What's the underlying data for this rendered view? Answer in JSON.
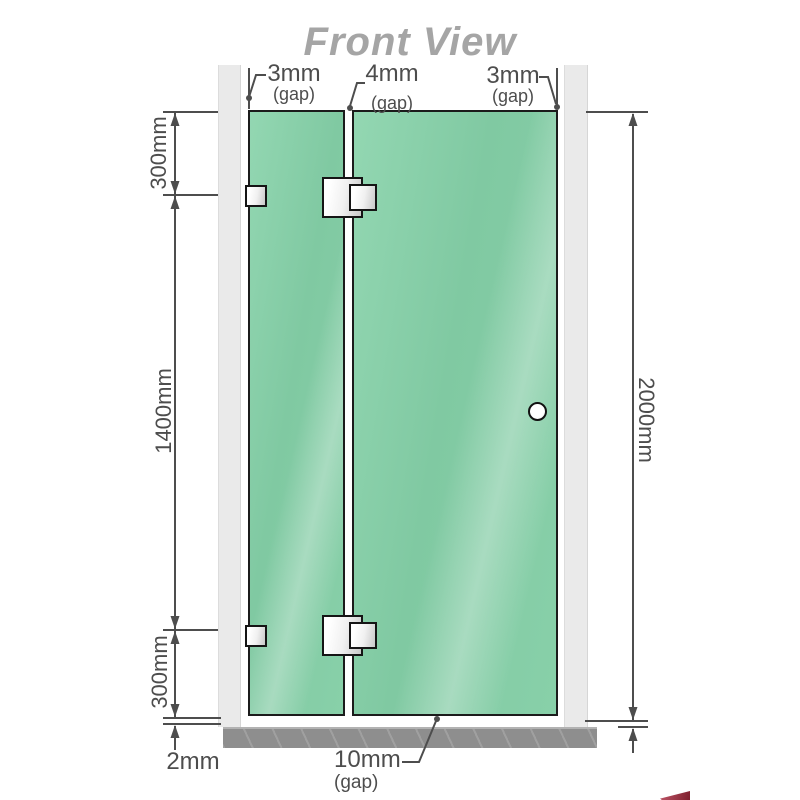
{
  "title": "Front View",
  "annotations": {
    "gap_top_left": {
      "value": "3mm",
      "note": "(gap)"
    },
    "gap_top_center": {
      "value": "4mm",
      "note": "(gap)"
    },
    "gap_top_right": {
      "value": "3mm",
      "note": "(gap)"
    },
    "left_top": "300mm",
    "left_middle": "1400mm",
    "left_bottom": "300mm",
    "right_height": "2000mm",
    "bottom_left": "2mm",
    "gap_bottom": {
      "value": "10mm",
      "note": "(gap)"
    }
  },
  "colors": {
    "glass": "#80c9a2",
    "glass_highlight": "#93d7b2",
    "wall_channel": "#eaeaea",
    "floor": "#8e8e8e",
    "line": "#4d4d4d",
    "label_text": "#4d4d4d",
    "title_text": "#a5a5a5",
    "hardware_fill": "#f0f0f0",
    "hardware_border": "#151515",
    "logo_red": "#7d1f2d"
  }
}
